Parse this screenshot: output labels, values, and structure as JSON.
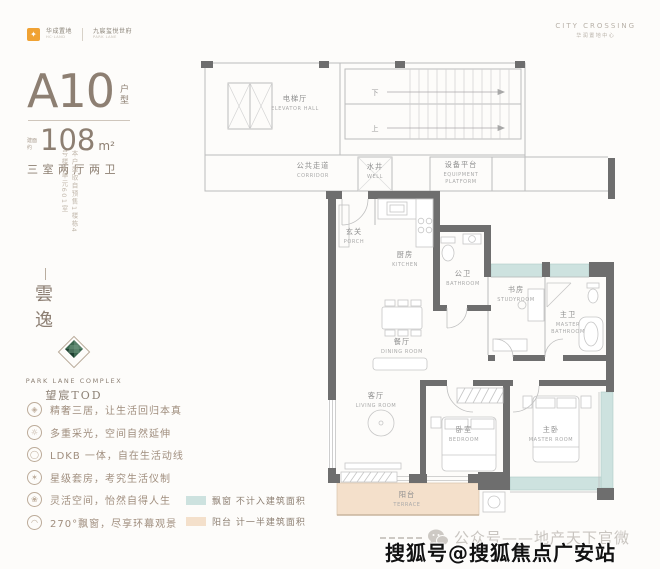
{
  "header": {
    "brand": {
      "logo_glyph": "✦",
      "left_name": "华成置地",
      "left_sub": "HC·LAND",
      "right_name": "九宸玺悦世府",
      "right_sub": "PARK LANE"
    },
    "project": {
      "en": "CITY CROSSING",
      "cn": "华润置地中心"
    }
  },
  "left": {
    "unit": {
      "code": "A10",
      "code_suffix": "户型",
      "area_prefix_top": "建面",
      "area_prefix_bottom": "约",
      "area_value": "108",
      "area_unit": "m²",
      "layout": "三室两厅两卫"
    },
    "source_note": "本户型取自预售1楼栋4号楼4单元601室",
    "project_name_vertical": "雲逸",
    "tod_logo": {
      "en": "PARK LANE COMPLEX",
      "cn": "望宸TOD"
    },
    "bullets": [
      {
        "icon": "diamond-icon",
        "glyph": "◈",
        "text": "精奢三居，让生活回归本真"
      },
      {
        "icon": "sun-icon",
        "glyph": "☼",
        "text": "多重采光，空间自然延伸"
      },
      {
        "icon": "flow-icon",
        "glyph": "◯",
        "text": "LDKB 一体，自在生活动线"
      },
      {
        "icon": "star-icon",
        "glyph": "✶",
        "text": "星级套房，考究生活仪制"
      },
      {
        "icon": "flower-icon",
        "glyph": "❀",
        "text": "灵活空间，怡然自得人生"
      },
      {
        "icon": "fan-icon",
        "glyph": "◠",
        "text": "270°飘窗，尽享环幕观景"
      }
    ]
  },
  "legend": [
    {
      "name": "bay-window",
      "swatch_style": "background:#cde2df",
      "label": "飘窗 不计入建筑面积"
    },
    {
      "name": "terrace",
      "swatch_style": "background:#f4e0cb",
      "label": "阳台 计一半建筑面积"
    }
  ],
  "floorplan": {
    "rooms": [
      {
        "cn": "电梯厅",
        "en": "ELEVATOR HALL",
        "x": 100,
        "y": 46
      },
      {
        "cn": "公共走道",
        "en": "CORRIDOR",
        "x": 118,
        "y": 113
      },
      {
        "cn": "水井",
        "en": "WELL",
        "x": 180,
        "y": 114
      },
      {
        "cn": "设备平台",
        "en": "EQUIPMENT",
        "en2": "PLATFORM",
        "x": 266,
        "y": 112
      },
      {
        "cn": "玄关",
        "en": "PORCH",
        "x": 159,
        "y": 179
      },
      {
        "cn": "厨房",
        "en": "KITCHEN",
        "x": 210,
        "y": 202
      },
      {
        "cn": "公卫",
        "en": "BATHROOM",
        "x": 268,
        "y": 221
      },
      {
        "cn": "书房",
        "en": "STUDYROOM",
        "x": 321,
        "y": 237
      },
      {
        "cn": "主卫",
        "en": "MASTER",
        "en2": "BATHROOM",
        "x": 373,
        "y": 262
      },
      {
        "cn": "餐厅",
        "en": "DINING ROOM",
        "x": 207,
        "y": 289
      },
      {
        "cn": "客厅",
        "en": "LIVING ROOM",
        "x": 181,
        "y": 343
      },
      {
        "cn": "卧室",
        "en": "BEDROOM",
        "x": 269,
        "y": 377
      },
      {
        "cn": "主卧",
        "en": "MASTER ROOM",
        "x": 356,
        "y": 377
      },
      {
        "cn": "阳台",
        "en": "TERRACE",
        "x": 212,
        "y": 442
      }
    ],
    "stairs": {
      "down": "下",
      "up": "上"
    }
  },
  "watermarks": {
    "wechat": "公众号——地产天下官微",
    "sohu": "搜狐号@搜狐焦点广安站"
  },
  "colors": {
    "accent_taupe": "#8d7f72",
    "bay_window_teal": "#cde2df",
    "terrace_peach": "#f4e0cb",
    "brand_orange": "#f0a233",
    "wall_dark": "#6e6e6e"
  }
}
